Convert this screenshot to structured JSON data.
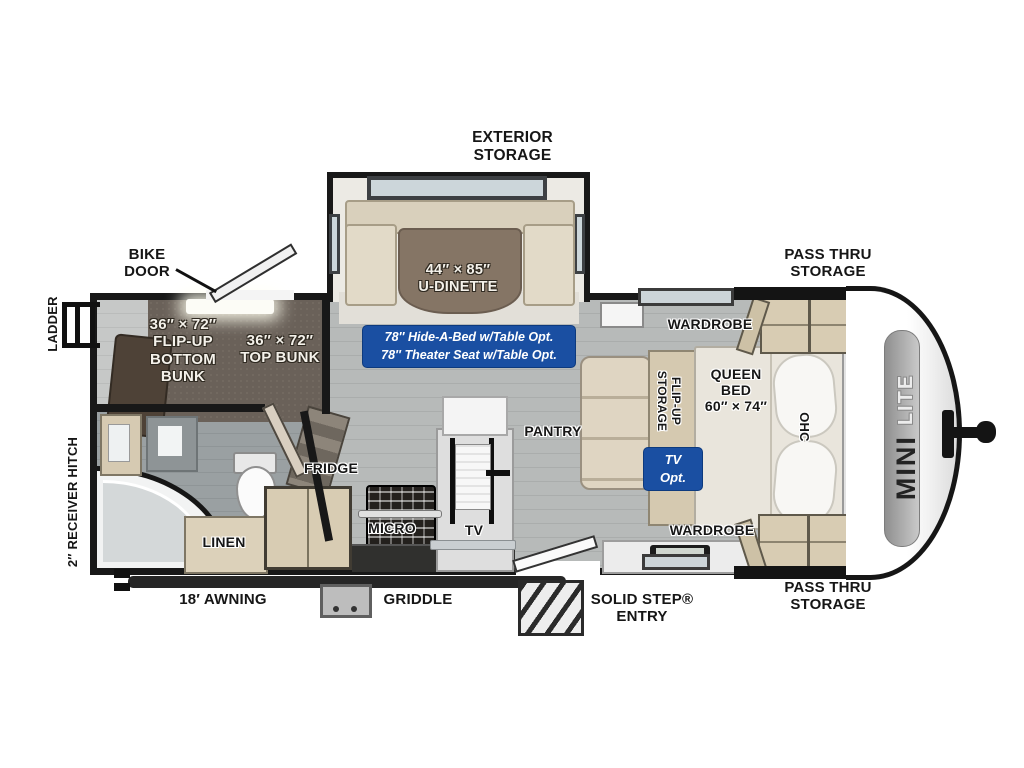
{
  "colors": {
    "badge_blue": "#1a4fa2",
    "wall_black": "#181818",
    "floor_gray": "#b4b7b6",
    "cabinet_tan": "#d8ccb3",
    "bunk_carpet": "#6a6159"
  },
  "exterior": {
    "exterior_storage": "EXTERIOR\nSTORAGE",
    "bike_door": "BIKE\nDOOR",
    "pass_thru_top": "PASS THRU\nSTORAGE",
    "pass_thru_bottom": "PASS THRU\nSTORAGE",
    "ladder": "LADDER",
    "receiver_hitch": "2″ RECEIVER HITCH",
    "awning": "18′ AWNING",
    "griddle": "GRIDDLE",
    "solid_step": "SOLID STEP®\nENTRY"
  },
  "interior": {
    "u_dinette": "44″ × 85″\nU-DINETTE",
    "bottom_bunk": "36″ × 72″\nFLIP-UP\nBOTTOM\nBUNK",
    "top_bunk": "36″ × 72″\nTOP BUNK",
    "fridge": "FRIDGE",
    "micro": "MICRO",
    "tv": "TV",
    "pantry": "PANTRY",
    "linen": "LINEN",
    "wardrobe_top": "WARDROBE",
    "wardrobe_bottom": "WARDROBE",
    "queen_bed": "QUEEN\nBED\n60″ × 74″",
    "flip_up_storage": "FLIP-UP\nSTORAGE",
    "ohc": "OHC"
  },
  "badges": {
    "hide_a_bed": "78″ Hide-A-Bed w/Table Opt.\n78″ Theater Seat w/Table Opt.",
    "tv_opt": "TV Opt."
  },
  "brand": {
    "mini": "MINI",
    "lite": "LITE"
  }
}
